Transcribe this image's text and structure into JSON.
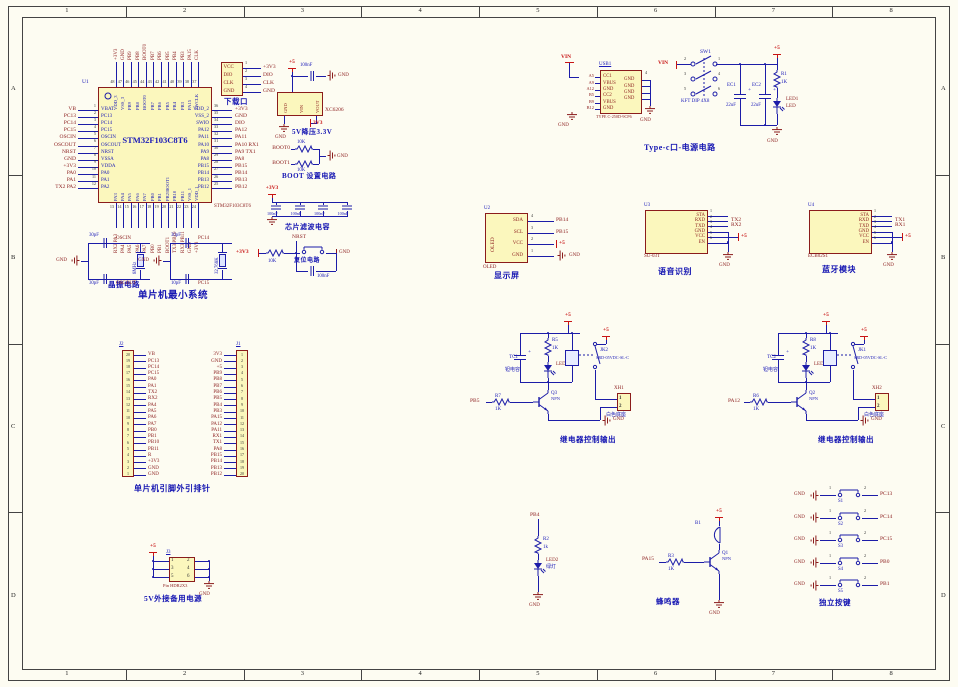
{
  "frame": {
    "cols": [
      "1",
      "2",
      "3",
      "4",
      "5",
      "6",
      "7",
      "8"
    ],
    "rows": [
      "A",
      "B",
      "C",
      "D"
    ]
  },
  "mcu": {
    "designator": "U1",
    "name": "STM32F103C8T6",
    "part_label": "STM32F103C8T6",
    "title": "单片机最小系统",
    "left_pins": [
      {
        "net": "VB",
        "num": "1",
        "name": "VBAT"
      },
      {
        "net": "PC13",
        "num": "2",
        "name": "PC13"
      },
      {
        "net": "PC14",
        "num": "3",
        "name": "PC14"
      },
      {
        "net": "PC15",
        "num": "4",
        "name": "PC15"
      },
      {
        "net": "OSCIN",
        "num": "5",
        "name": "OSCIN"
      },
      {
        "net": "OSCOUT",
        "num": "6",
        "name": "OSCOUT"
      },
      {
        "net": "NRST",
        "num": "7",
        "name": "NRST"
      },
      {
        "net": "GND",
        "num": "8",
        "name": "VSSA"
      },
      {
        "net": "+3V3",
        "num": "9",
        "name": "VDDA"
      },
      {
        "net": "PA0",
        "num": "10",
        "name": "PA0"
      },
      {
        "net": "PA1",
        "num": "11",
        "name": "PA1"
      },
      {
        "net": "TX2 PA2",
        "num": "12",
        "name": "PA2"
      }
    ],
    "right_pins": [
      {
        "net": "+3V3",
        "num": "36",
        "name": "VDD_2"
      },
      {
        "net": "GND",
        "num": "35",
        "name": "VSS_2"
      },
      {
        "net": "DIO",
        "num": "34",
        "name": "SWIO"
      },
      {
        "net": "PA12",
        "num": "33",
        "name": "PA12"
      },
      {
        "net": "PA11",
        "num": "32",
        "name": "PA11"
      },
      {
        "net": "PA10 RX1",
        "num": "31",
        "name": "PA10"
      },
      {
        "net": "PA9 TX1",
        "num": "30",
        "name": "PA9"
      },
      {
        "net": "PA8",
        "num": "29",
        "name": "PA8"
      },
      {
        "net": "PB15",
        "num": "28",
        "name": "PB15"
      },
      {
        "net": "PB14",
        "num": "27",
        "name": "PB14"
      },
      {
        "net": "PB13",
        "num": "26",
        "name": "PB13"
      },
      {
        "net": "PB12",
        "num": "25",
        "name": "PB12"
      }
    ],
    "top_pins": [
      {
        "net": "+3V3",
        "num": "48",
        "name": "VDD_3"
      },
      {
        "net": "GND",
        "num": "47",
        "name": "VSS_3"
      },
      {
        "net": "PB9",
        "num": "46",
        "name": "PB9"
      },
      {
        "net": "PB8",
        "num": "45",
        "name": "PB8"
      },
      {
        "net": "BOOT0",
        "num": "44",
        "name": "BOOT0"
      },
      {
        "net": "PB7",
        "num": "43",
        "name": "PB7"
      },
      {
        "net": "PB6",
        "num": "42",
        "name": "PB6"
      },
      {
        "net": "PB5",
        "num": "41",
        "name": "PB5"
      },
      {
        "net": "PB4",
        "num": "40",
        "name": "PB4"
      },
      {
        "net": "PB3",
        "num": "39",
        "name": "PB3"
      },
      {
        "net": "PA15",
        "num": "38",
        "name": "PA15"
      },
      {
        "net": "CLK",
        "num": "37",
        "name": "SWCLK"
      }
    ],
    "bottom_pins": [
      {
        "net": "RX2 PA3",
        "num": "13",
        "name": "PA3"
      },
      {
        "net": "PA4",
        "num": "14",
        "name": "PA4"
      },
      {
        "net": "PA5",
        "num": "15",
        "name": "PA5"
      },
      {
        "net": "PA6",
        "num": "16",
        "name": "PA6"
      },
      {
        "net": "PA7",
        "num": "17",
        "name": "PA7"
      },
      {
        "net": "PB0",
        "num": "18",
        "name": "PB0"
      },
      {
        "net": "PB1",
        "num": "19",
        "name": "PB1"
      },
      {
        "net": "BOOT1",
        "num": "20",
        "name": "PB2/BOOT1"
      },
      {
        "net": "TX3 PB10",
        "num": "21",
        "name": "PB10"
      },
      {
        "net": "RX3 PB11",
        "num": "22",
        "name": "PB11"
      },
      {
        "net": "GND",
        "num": "23",
        "name": "VSS_1"
      },
      {
        "net": "+3V3",
        "num": "24",
        "name": "VDD_1"
      }
    ]
  },
  "crystal": {
    "title": "晶振电路",
    "groups": [
      {
        "cap_top": "30pF",
        "cap_bottom": "30pF",
        "value": "8MHz",
        "net_top": "OSCIN",
        "net_bottom": "OSCOUT",
        "gnd": "GND"
      },
      {
        "cap_top": "30pF",
        "cap_bottom": "10pF",
        "value": "32.768K",
        "net_top": "PC14",
        "net_bottom": "PC15",
        "gnd": "GND"
      }
    ]
  },
  "download": {
    "title": "下载口",
    "rows": [
      {
        "name": "VCC",
        "num": "1",
        "net": "+3V3"
      },
      {
        "name": "DIO",
        "num": "2",
        "net": "DIO"
      },
      {
        "name": "CLK",
        "num": "3",
        "net": "CLK"
      },
      {
        "name": "GND",
        "num": "4",
        "net": "GND"
      }
    ]
  },
  "ldo": {
    "title": "5V降压3.3V",
    "part": "XC6206",
    "pin_labels": [
      "GND",
      "VIN",
      "VOUT"
    ],
    "power": "+5",
    "cap": "100nF",
    "gnd_top": "GND",
    "gnd_bottom": "GND",
    "out": "3V3"
  },
  "boot": {
    "title": "BOOT 设置电路",
    "gnd": "GND",
    "rows": [
      {
        "net": "BOOT0",
        "res": "10K"
      },
      {
        "net": "BOOT1",
        "res": "10K"
      }
    ]
  },
  "filter": {
    "title": "芯片滤波电容",
    "power": "+3V3",
    "caps": [
      "100nF",
      "100nF",
      "100nF",
      "100nF"
    ]
  },
  "reset": {
    "title": "复位电路",
    "power": "+3V3",
    "res": "10K",
    "net": "NRST",
    "cap": "100nF",
    "gnd": "GND"
  },
  "typec": {
    "title": "Type-c口-电源电路",
    "power": "+5",
    "gnd": "GND",
    "usb": {
      "designator": "USB1",
      "part": "TYPE C-250D-9CP6",
      "vin": "VIN",
      "gnd_left": "GND",
      "gnd_right": "GND",
      "right_pin_num": "4",
      "left_pins": [
        "A5",
        "A9",
        "A12",
        "B5",
        "B9",
        "B12"
      ],
      "rows": [
        "CC1",
        "VBUS",
        "GND",
        "CC2",
        "VBUS",
        "GND"
      ],
      "right_rows": [
        "GND",
        "GND",
        "GND",
        "GND"
      ]
    },
    "sw": {
      "designator": "SW1",
      "part": "KFT DIP 4X8",
      "vin": "VIN",
      "pin_pairs": [
        [
          "2",
          "1"
        ],
        [
          "3",
          "4"
        ],
        [
          "5",
          "6"
        ]
      ]
    },
    "caps": [
      {
        "d": "EC1",
        "v": "22uF"
      },
      {
        "d": "EC2",
        "v": "22uF"
      }
    ],
    "res": {
      "d": "R1",
      "v": "1K"
    },
    "led": {
      "d": "LED1",
      "v": "LED"
    }
  },
  "oled": {
    "title": "显示屏",
    "designator": "U2",
    "part": "OLED",
    "bottom_label": "OLED",
    "rows": [
      {
        "name": "SDA",
        "num": "4",
        "net": "PB14"
      },
      {
        "name": "SCL",
        "num": "3",
        "net": "PB15"
      },
      {
        "name": "VCC",
        "num": "2",
        "net": "+5"
      },
      {
        "name": "GND",
        "num": "1",
        "net": "GND"
      }
    ]
  },
  "voice": {
    "title": "语音识别",
    "designator": "U3",
    "bottom_label": "SU-03T",
    "gnd": "GND",
    "rows": [
      {
        "name": "STA",
        "num": "1",
        "net": ""
      },
      {
        "name": "RXD",
        "num": "2",
        "net": "TX2"
      },
      {
        "name": "TXD",
        "num": "3",
        "net": "RX2"
      },
      {
        "name": "GND",
        "num": "4",
        "net": ""
      },
      {
        "name": "VCC",
        "num": "5",
        "net": "+5"
      },
      {
        "name": "EN",
        "num": "6",
        "net": ""
      }
    ]
  },
  "bt": {
    "title": "蓝牙模块",
    "designator": "U4",
    "bottom_label": "ECB02S1",
    "gnd": "GND",
    "rows": [
      {
        "name": "STA",
        "num": "1",
        "net": ""
      },
      {
        "name": "RXD",
        "num": "2",
        "net": "TX1"
      },
      {
        "name": "TXD",
        "num": "3",
        "net": "RX1"
      },
      {
        "name": "GND",
        "num": "4",
        "net": ""
      },
      {
        "name": "VCC",
        "num": "5",
        "net": "+5"
      },
      {
        "name": "EN",
        "num": "6",
        "net": ""
      }
    ]
  },
  "relay1": {
    "title": "继电器控制输出",
    "power": "+5",
    "gnd": "GND",
    "input_net": "PB5",
    "cap": {
      "d": "TC1",
      "v": "钽电容"
    },
    "top_res": {
      "d": "R5",
      "v": "1K"
    },
    "led": "LED4",
    "relay": {
      "d": "JK2",
      "v": "SRD-05VDC-SL-C"
    },
    "q": {
      "d": "Q3",
      "v": "NPN"
    },
    "base_res": {
      "d": "R7",
      "v": "1K"
    },
    "conn": {
      "d": "XH1",
      "v": "白色底座",
      "pins": [
        "1",
        "2"
      ]
    }
  },
  "relay2": {
    "title": "继电器控制输出",
    "power": "+5",
    "gnd": "GND",
    "input_net": "PA12",
    "cap": {
      "d": "TC2",
      "v": "钽电容"
    },
    "top_res": {
      "d": "R8",
      "v": "1K"
    },
    "led": "LED3",
    "relay": {
      "d": "JK1",
      "v": "SRD-05VDC-SL-C"
    },
    "q": {
      "d": "Q2",
      "v": "NPN"
    },
    "base_res": {
      "d": "R6",
      "v": "1K"
    },
    "conn": {
      "d": "XH2",
      "v": "白色底座",
      "pins": [
        "1",
        "2"
      ]
    }
  },
  "headers": {
    "title": "单片机引脚外引排针",
    "left": {
      "designator": "J2",
      "pins": [
        {
          "num": "20",
          "net": "VB"
        },
        {
          "num": "19",
          "net": "PC13"
        },
        {
          "num": "18",
          "net": "PC14"
        },
        {
          "num": "17",
          "net": "PC15"
        },
        {
          "num": "16",
          "net": "PA0"
        },
        {
          "num": "15",
          "net": "PA1"
        },
        {
          "num": "14",
          "net": "TX2"
        },
        {
          "num": "13",
          "net": "RX2"
        },
        {
          "num": "12",
          "net": "PA4"
        },
        {
          "num": "11",
          "net": "PA5"
        },
        {
          "num": "10",
          "net": "PA6"
        },
        {
          "num": "9",
          "net": "PA7"
        },
        {
          "num": "8",
          "net": "PB0"
        },
        {
          "num": "7",
          "net": "PB1"
        },
        {
          "num": "6",
          "net": "PB10"
        },
        {
          "num": "5",
          "net": "PB11"
        },
        {
          "num": "4",
          "net": "R"
        },
        {
          "num": "3",
          "net": "+3V3"
        },
        {
          "num": "2",
          "net": "GND"
        },
        {
          "num": "1",
          "net": "GND"
        }
      ]
    },
    "right": {
      "designator": "J1",
      "pins": [
        {
          "num": "1",
          "net": "3V3"
        },
        {
          "num": "2",
          "net": "GND"
        },
        {
          "num": "3",
          "net": "+5"
        },
        {
          "num": "4",
          "net": "PB9"
        },
        {
          "num": "5",
          "net": "PB8"
        },
        {
          "num": "6",
          "net": "PB7"
        },
        {
          "num": "7",
          "net": "PB6"
        },
        {
          "num": "8",
          "net": "PB5"
        },
        {
          "num": "9",
          "net": "PB4"
        },
        {
          "num": "10",
          "net": "PB3"
        },
        {
          "num": "11",
          "net": "PA15"
        },
        {
          "num": "12",
          "net": "PA12"
        },
        {
          "num": "13",
          "net": "PA11"
        },
        {
          "num": "14",
          "net": "RX1"
        },
        {
          "num": "15",
          "net": "TX1"
        },
        {
          "num": "16",
          "net": "PA8"
        },
        {
          "num": "17",
          "net": "PB15"
        },
        {
          "num": "18",
          "net": "PB14"
        },
        {
          "num": "19",
          "net": "PB13"
        },
        {
          "num": "20",
          "net": "PB12"
        }
      ]
    }
  },
  "backup": {
    "title": "5V外接备用电源",
    "designator": "J3",
    "part": "Pin HDR2X3",
    "power": "+5",
    "gnd": "GND",
    "left_nums": [
      "1",
      "3",
      "5"
    ],
    "right_nums": [
      "2",
      "4",
      "6"
    ]
  },
  "led_branch": {
    "net": "PB4",
    "res": {
      "d": "R2",
      "v": "1k"
    },
    "led": {
      "d": "LED2",
      "v": "绿灯"
    },
    "gnd": "GND"
  },
  "buzzer": {
    "title": "蜂鸣器",
    "power": "+5",
    "designator": "B1",
    "q": {
      "d": "Q1",
      "v": "NPN"
    },
    "res": {
      "d": "R3",
      "v": "1K"
    },
    "net": "PA15",
    "gnd": "GND"
  },
  "keys": {
    "title": "独立按键",
    "pin1": "1",
    "pin2": "2",
    "gnd": "GND",
    "rows": [
      {
        "sw": "S1",
        "net": "PC13"
      },
      {
        "sw": "S2",
        "net": "PC14"
      },
      {
        "sw": "S3",
        "net": "PC15"
      },
      {
        "sw": "S4",
        "net": "PB0"
      },
      {
        "sw": "S5",
        "net": "PB1"
      }
    ]
  }
}
